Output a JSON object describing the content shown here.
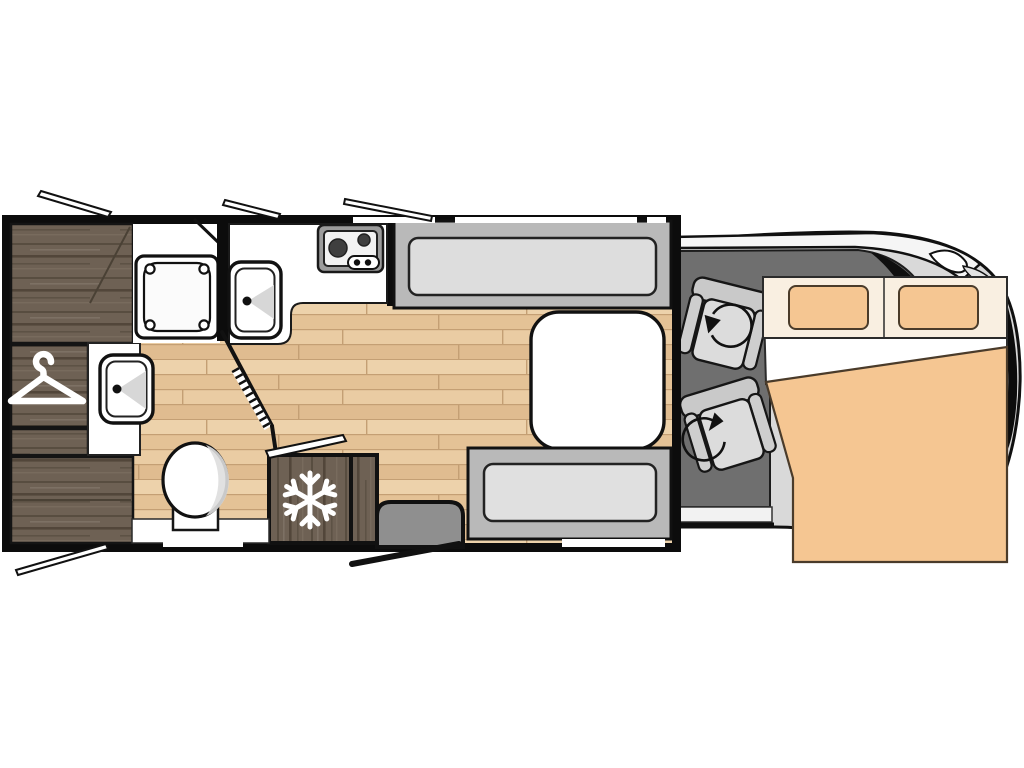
{
  "plan": {
    "title": "motorhome-floorplan",
    "kind": "overhead vehicle floor plan, no visible text labels"
  },
  "colors": {
    "wall": "#0c0c0c",
    "floor_base": "#e8c9a0",
    "floor_seam": "#c49f74",
    "dark_wood": "#6e6154",
    "dark_wood_streak": "#55493c",
    "counter_white": "#ffffff",
    "bench_gray": "#b9b9b9",
    "cushion_gray": "#dddddd",
    "table_white": "#ffffff",
    "cab_floor_gray": "#6f6f6f",
    "seat_gray": "#dcdcdc",
    "seat_back_gray": "#c9c9c9",
    "step_gray": "#8f8f8f",
    "body_gray": "#d9d9d9",
    "windshield_gray": "#6f6f6f",
    "bed_orange": "#f5c692",
    "bed_cream": "#f9efe1",
    "icon_white": "#ffffff"
  },
  "features": [
    {
      "id": "rear-cabinet",
      "label": "rear cabinet block"
    },
    {
      "id": "wardrobe",
      "label": "wardrobe with clothes hanger icon"
    },
    {
      "id": "hanger-icon",
      "label": "clothes-hanger icon"
    },
    {
      "id": "lower-cabinet",
      "label": "lower rear cabinet block"
    },
    {
      "id": "shower",
      "label": "shower cubicle with tray"
    },
    {
      "id": "bathroom-sink",
      "label": "bathroom washbasin"
    },
    {
      "id": "toilet",
      "label": "toilet"
    },
    {
      "id": "bathroom-door",
      "label": "folding bathroom door (open)"
    },
    {
      "id": "kitchen-counter",
      "label": "kitchen worktop"
    },
    {
      "id": "hob",
      "label": "two-burner hob with control knobs"
    },
    {
      "id": "kitchen-sink",
      "label": "kitchen sink"
    },
    {
      "id": "fridge",
      "label": "refrigerator with snowflake icon"
    },
    {
      "id": "snowflake-icon",
      "label": "snowflake icon"
    },
    {
      "id": "side-cabinet",
      "label": "narrow cabinet beside fridge"
    },
    {
      "id": "dinette-front-bench",
      "label": "dinette bench (front)"
    },
    {
      "id": "dinette-rear-bench",
      "label": "dinette bench (rear)"
    },
    {
      "id": "dinette-table",
      "label": "dinette table"
    },
    {
      "id": "entry-step",
      "label": "entrance step"
    },
    {
      "id": "entry-door",
      "label": "entrance door swing (open)"
    },
    {
      "id": "driver-swivel-seat",
      "label": "cab swivel seat with rotation arrow"
    },
    {
      "id": "passenger-swivel-seat",
      "label": "cab swivel seat with rotation arrow"
    },
    {
      "id": "swivel-arrow-icon",
      "label": "rotation arrow icon"
    },
    {
      "id": "overcab-bed",
      "label": "over-cab double bed with two pillows and duvet"
    },
    {
      "id": "vehicle-cab",
      "label": "vehicle cab / front body"
    },
    {
      "id": "window-flaps",
      "label": "four opened window flaps"
    },
    {
      "id": "wall-windows",
      "label": "window openings in walls"
    }
  ]
}
